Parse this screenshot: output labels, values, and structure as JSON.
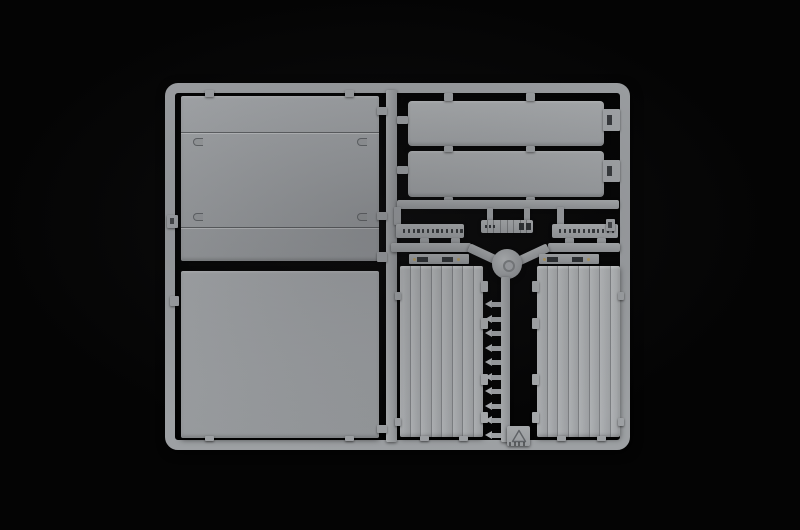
{
  "scene": {
    "subject": "Injection-molded model kit sprue with light gray trailer body panels photographed on a black background",
    "background_color": "#040404",
    "plastic_color": "#9da0a3",
    "plastic_highlight": "#b2b5b7",
    "plastic_shadow": "#84878a",
    "paint_dot_color": "#b59c62"
  },
  "sprue": {
    "frame": {
      "name": "sprue-frame"
    },
    "left_upper_panel": {
      "name": "large-side-panel-with-seams",
      "seam_count": 2,
      "corner_clips": 4
    },
    "left_lower_panel": {
      "name": "large-plain-panel"
    },
    "roof_panels": {
      "count": 2,
      "name": "long-roof-panel",
      "end_tabs": 2
    },
    "perforated_strips": {
      "left_holes": 13,
      "right_holes": 12
    },
    "ladder_strip": {
      "segments": 8,
      "left_dots": 3,
      "right_slots": 2
    },
    "hub": {
      "name": "runner-hub"
    },
    "hinge_bars": {
      "count": 2,
      "slots_each": 2,
      "paint_dots_each": 2
    },
    "ribbed_doors": {
      "count": 2,
      "planks": 8,
      "edge_tabs_each": 4
    },
    "small_clips": {
      "count": 10
    },
    "material_tag": {
      "symbol": "recycling-triangle",
      "ticks": 4
    }
  }
}
